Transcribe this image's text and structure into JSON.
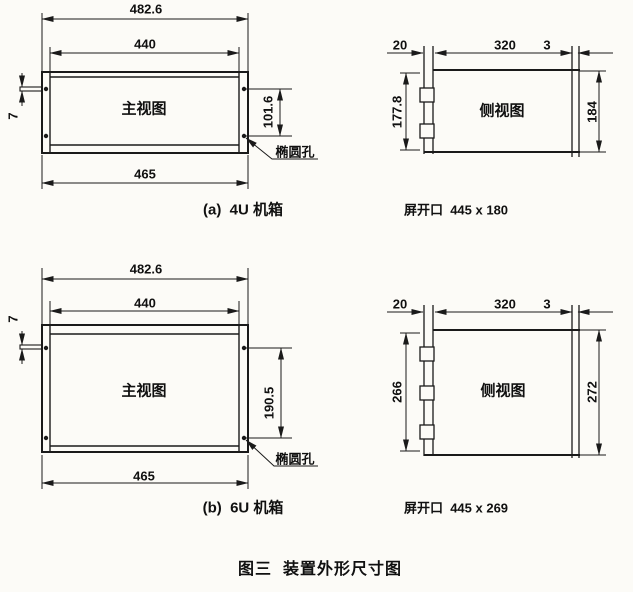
{
  "caption": "图三  装置外形尺寸图",
  "colors": {
    "line": "#1a1a1a",
    "text": "#101010",
    "background": "#fcfbf7"
  },
  "views": {
    "front_4u": {
      "title": "主视图",
      "label": "(a)  4U 机箱",
      "hole_callout": "椭圆孔",
      "dims": {
        "overall_width": "482.6",
        "panel_width": "440",
        "body_width": "465",
        "hole_spacing": "101.6",
        "pin_width": "7"
      }
    },
    "side_4u": {
      "title": "侧视图",
      "cutout_label": "屏开口  445 x 180",
      "dims": {
        "front_depth": "20",
        "body_depth": "320",
        "rear_gap": "3",
        "body_height": "177.8",
        "panel_height": "184"
      }
    },
    "front_6u": {
      "title": "主视图",
      "label": "(b)  6U 机箱",
      "hole_callout": "椭圆孔",
      "dims": {
        "overall_width": "482.6",
        "panel_width": "440",
        "body_width": "465",
        "hole_spacing": "190.5",
        "pin_width": "7"
      }
    },
    "side_6u": {
      "title": "侧视图",
      "cutout_label": "屏开口  445 x 269",
      "dims": {
        "front_depth": "20",
        "body_depth": "320",
        "rear_gap": "3",
        "body_height": "266",
        "panel_height": "272"
      }
    }
  }
}
